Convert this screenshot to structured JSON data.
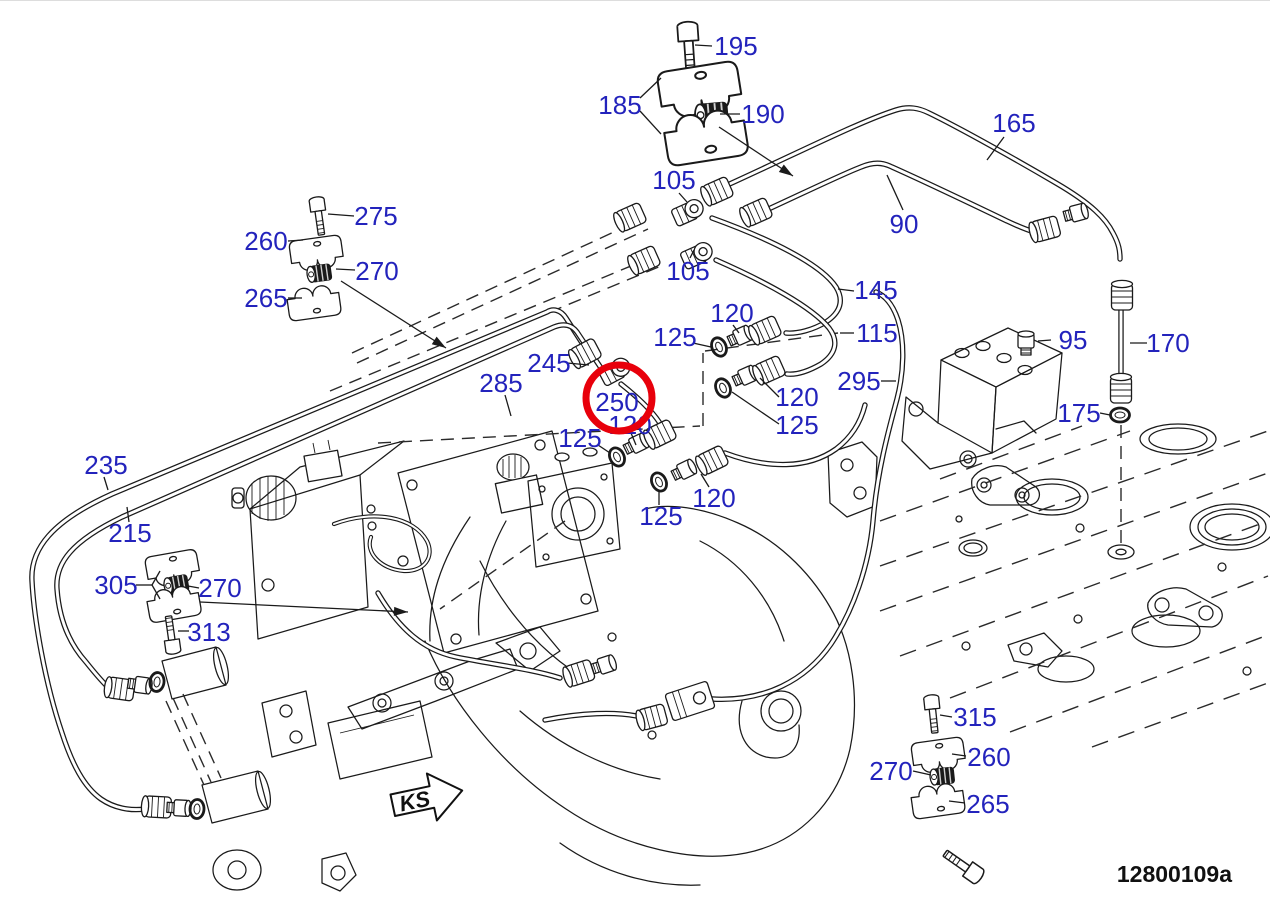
{
  "drawing": {
    "caption": "12800109a",
    "direction_label": "KS"
  },
  "colors": {
    "label": "#2323bc",
    "line": "#1a1a1a",
    "highlight": "#e8000b",
    "background": "#ffffff"
  },
  "highlight_circle": {
    "part": "250",
    "cx": 619,
    "cy": 397,
    "r": 33,
    "stroke_width": 7
  },
  "leader_arrows": [
    {
      "x1": 719,
      "y1": 126,
      "x2": 793,
      "y2": 175
    },
    {
      "x1": 341,
      "y1": 280,
      "x2": 446,
      "y2": 347
    },
    {
      "x1": 200,
      "y1": 601,
      "x2": 408,
      "y2": 611
    }
  ],
  "callouts": [
    {
      "text": "195",
      "x": 736,
      "y": 45,
      "leaders": [
        [
          712,
          45,
          695,
          44
        ]
      ]
    },
    {
      "text": "185",
      "x": 620,
      "y": 104,
      "leaders": [
        [
          640,
          97,
          661,
          77
        ],
        [
          640,
          110,
          661,
          133
        ]
      ]
    },
    {
      "text": "190",
      "x": 763,
      "y": 113,
      "leaders": [
        [
          740,
          113,
          720,
          113
        ]
      ]
    },
    {
      "text": "165",
      "x": 1014,
      "y": 122,
      "leaders": [
        [
          1004,
          136,
          987,
          159
        ]
      ]
    },
    {
      "text": "90",
      "x": 904,
      "y": 223,
      "leaders": [
        [
          903,
          209,
          887,
          174
        ]
      ]
    },
    {
      "text": "105",
      "x": 674,
      "y": 179,
      "leaders": [
        [
          679,
          192,
          687,
          201
        ]
      ]
    },
    {
      "text": "105",
      "x": 688,
      "y": 270,
      "leaders": [
        [
          690,
          257,
          694,
          249
        ]
      ]
    },
    {
      "text": "145",
      "x": 876,
      "y": 289,
      "leaders": [
        [
          854,
          290,
          838,
          288
        ]
      ]
    },
    {
      "text": "115",
      "x": 877,
      "y": 332,
      "leaders": [
        [
          854,
          332,
          840,
          332
        ]
      ]
    },
    {
      "text": "120",
      "x": 732,
      "y": 312,
      "leaders": [
        [
          733,
          324,
          739,
          332
        ]
      ]
    },
    {
      "text": "125",
      "x": 675,
      "y": 336,
      "leaders": [
        [
          693,
          342,
          711,
          346
        ]
      ]
    },
    {
      "text": "245",
      "x": 549,
      "y": 362,
      "leaders": [
        [
          567,
          362,
          589,
          364
        ]
      ]
    },
    {
      "text": "285",
      "x": 501,
      "y": 382,
      "leaders": [
        [
          505,
          394,
          511,
          415
        ]
      ]
    },
    {
      "text": "250",
      "x": 617,
      "y": 401,
      "leaders": []
    },
    {
      "text": "120",
      "x": 630,
      "y": 424,
      "leaders": [
        [
          631,
          432,
          636,
          444
        ]
      ]
    },
    {
      "text": "125",
      "x": 580,
      "y": 437,
      "leaders": [
        [
          598,
          444,
          610,
          452
        ]
      ]
    },
    {
      "text": "120",
      "x": 797,
      "y": 396,
      "leaders": [
        [
          779,
          396,
          760,
          377
        ]
      ]
    },
    {
      "text": "125",
      "x": 797,
      "y": 424,
      "leaders": [
        [
          779,
          423,
          732,
          391
        ]
      ]
    },
    {
      "text": "120",
      "x": 714,
      "y": 497,
      "leaders": [
        [
          709,
          486,
          701,
          473
        ]
      ]
    },
    {
      "text": "125",
      "x": 661,
      "y": 515,
      "leaders": [
        [
          659,
          504,
          659,
          489
        ]
      ]
    },
    {
      "text": "295",
      "x": 859,
      "y": 380,
      "leaders": [
        [
          881,
          380,
          896,
          380
        ]
      ]
    },
    {
      "text": "95",
      "x": 1073,
      "y": 339,
      "leaders": [
        [
          1051,
          339,
          1038,
          340
        ]
      ]
    },
    {
      "text": "170",
      "x": 1168,
      "y": 342,
      "leaders": [
        [
          1147,
          342,
          1130,
          342
        ]
      ]
    },
    {
      "text": "175",
      "x": 1079,
      "y": 412,
      "leaders": [
        [
          1100,
          412,
          1110,
          414
        ]
      ]
    },
    {
      "text": "235",
      "x": 106,
      "y": 464,
      "leaders": [
        [
          104,
          476,
          108,
          489
        ]
      ]
    },
    {
      "text": "215",
      "x": 130,
      "y": 532,
      "leaders": [
        [
          129,
          521,
          127,
          506
        ]
      ]
    },
    {
      "text": "305",
      "x": 116,
      "y": 584,
      "leaders": [
        [
          136,
          584,
          152,
          584
        ],
        [
          152,
          584,
          160,
          570
        ],
        [
          152,
          584,
          160,
          598
        ]
      ]
    },
    {
      "text": "270",
      "x": 220,
      "y": 587,
      "leaders": [
        [
          199,
          587,
          188,
          585
        ]
      ]
    },
    {
      "text": "313",
      "x": 209,
      "y": 631,
      "leaders": [
        [
          189,
          630,
          178,
          630
        ]
      ]
    },
    {
      "text": "275",
      "x": 376,
      "y": 215,
      "leaders": [
        [
          354,
          215,
          328,
          213
        ]
      ]
    },
    {
      "text": "260",
      "x": 266,
      "y": 240,
      "leaders": [
        [
          288,
          240,
          303,
          239
        ]
      ]
    },
    {
      "text": "270",
      "x": 377,
      "y": 270,
      "leaders": [
        [
          355,
          269,
          336,
          268
        ]
      ]
    },
    {
      "text": "265",
      "x": 266,
      "y": 297,
      "leaders": [
        [
          288,
          297,
          302,
          297
        ]
      ]
    },
    {
      "text": "315",
      "x": 975,
      "y": 716,
      "leaders": [
        [
          952,
          716,
          940,
          714
        ]
      ]
    },
    {
      "text": "260",
      "x": 989,
      "y": 756,
      "leaders": [
        [
          966,
          755,
          952,
          753
        ]
      ]
    },
    {
      "text": "270",
      "x": 891,
      "y": 770,
      "leaders": [
        [
          913,
          770,
          931,
          774
        ]
      ]
    },
    {
      "text": "265",
      "x": 988,
      "y": 803,
      "leaders": [
        [
          965,
          802,
          949,
          800
        ]
      ]
    }
  ]
}
